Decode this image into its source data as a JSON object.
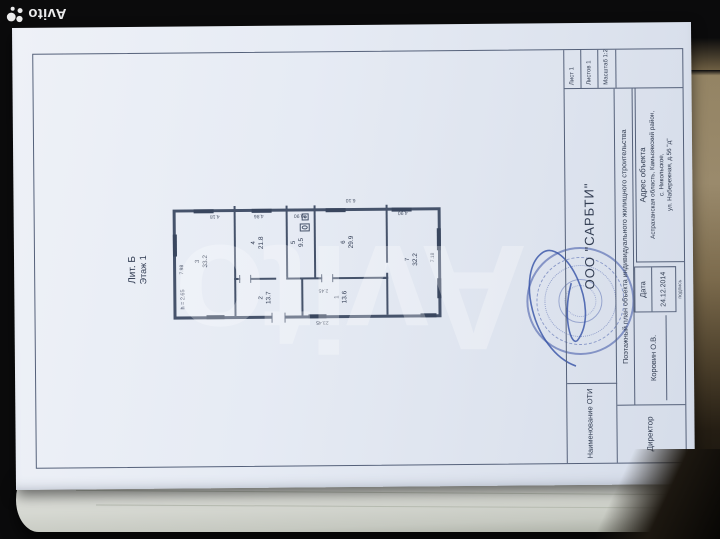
{
  "brand": {
    "corner_text": "Avito",
    "center_watermark": "Avito"
  },
  "document": {
    "plan_label": {
      "liter": "Лит. Б",
      "floor": "Этаж 1",
      "height_note": "h = 2.65"
    },
    "rooms": [
      {
        "num": "3",
        "area": "33.2"
      },
      {
        "num": "4",
        "area": "21.8"
      },
      {
        "num": "5",
        "area": "9.5"
      },
      {
        "num": "6",
        "area": "29.9"
      },
      {
        "num": "7",
        "area": "32.2"
      },
      {
        "num": "2",
        "area": "13.7"
      },
      {
        "num": "1",
        "area": "13.6"
      }
    ],
    "dims": [
      "7.98",
      "4.18",
      "4.86",
      "0.90",
      "6.10",
      "4.90",
      "7.18",
      "2.45",
      "23.45"
    ],
    "title_block": {
      "name_label": "Наименование ОТИ",
      "director_label": "Директор",
      "org": "ООО \"САРБТИ\"",
      "doc_title": "Поэтажный план объекта индивидуального жилищного строительства",
      "director_name": "Коровин О.В.",
      "signature_label": "подпись",
      "date_label": "Дата",
      "date_value": "24.12.2014",
      "address_label": "Адрес объекта",
      "address_lines": [
        "Астраханская область, Камызякский район,",
        "с. Никольское,",
        "ул. Набережная, д.56 \"д\""
      ],
      "sheet": "Лист 1",
      "sheets": "Листов 1",
      "scale": "Масштаб 1:200"
    }
  },
  "colors": {
    "stamp_blue": "#3e55a6",
    "drawing_line": "#46536b",
    "paper": "#e7ebf3"
  }
}
